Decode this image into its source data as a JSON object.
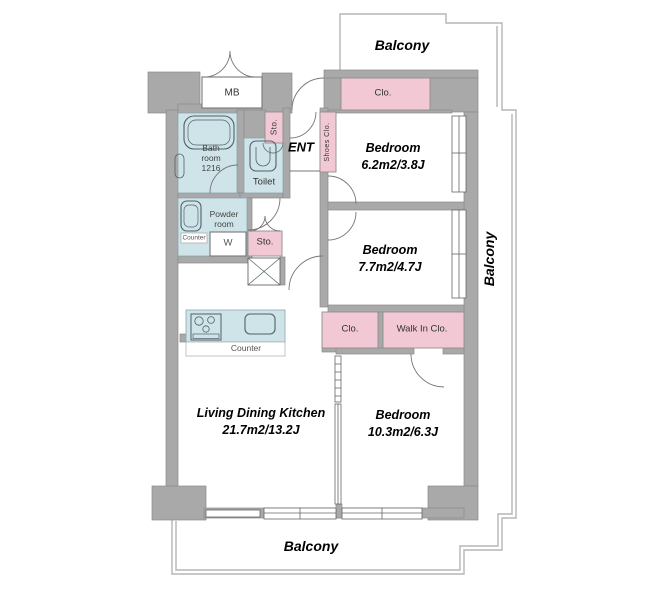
{
  "plan": {
    "colors": {
      "wall": "#a9a9a9",
      "wall_stroke": "#8b8b8b",
      "closet_pink": "#f2c8d5",
      "wet_blue": "#cfe4e9",
      "balcony_line": "#b5b5b5",
      "fixture": "#4f6066"
    },
    "balconies": {
      "top": "Balcony",
      "right": "Balcony",
      "bottom": "Balcony"
    },
    "entrance": {
      "label": "ENT"
    },
    "meter_box": {
      "label": "MB"
    },
    "rooms": {
      "bedroom1": {
        "name": "Bedroom",
        "size": "6.2m2/3.8J"
      },
      "bedroom2": {
        "name": "Bedroom",
        "size": "7.7m2/4.7J"
      },
      "bedroom3": {
        "name": "Bedroom",
        "size": "10.3m2/6.3J"
      },
      "ldk": {
        "name": "Living Dining Kitchen",
        "size": "21.7m2/13.2J"
      },
      "bath": {
        "l1": "Bath",
        "l2": "room",
        "l3": "1216"
      },
      "powder": {
        "l1": "Powder",
        "l2": "room"
      },
      "toilet": {
        "label": "Toilet"
      }
    },
    "storage": {
      "sto_entry": "Sto.",
      "shoes_clo": "Shoes Clo.",
      "sto_hall": "Sto.",
      "clo_bed1": "Clo.",
      "clo_bed3": "Clo.",
      "walk_in_clo": "Walk In Clo."
    },
    "fixtures": {
      "washer": "W",
      "kitchen_counter": "Counter",
      "powder_counter": "Counter"
    }
  }
}
